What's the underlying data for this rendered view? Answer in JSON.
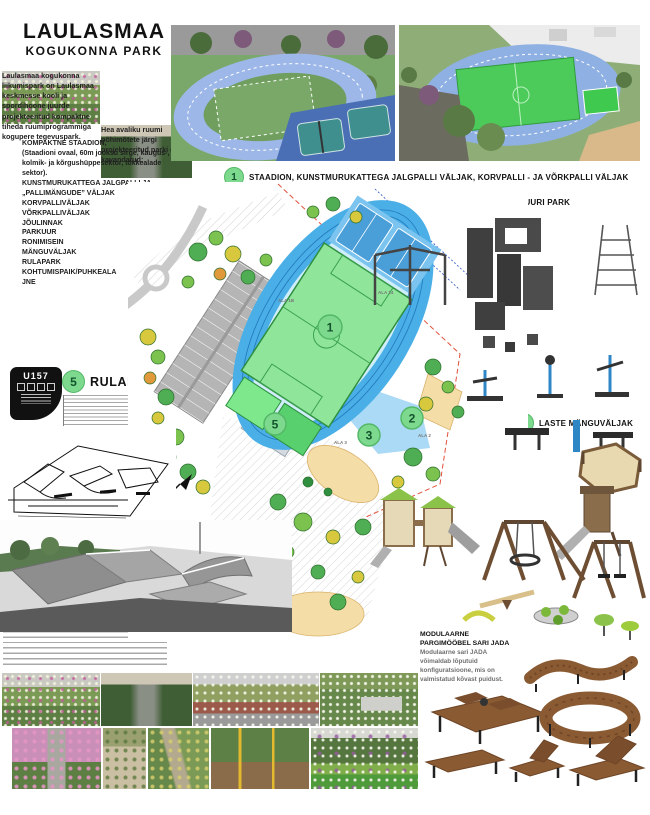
{
  "title": {
    "line1": "LAULASMAA",
    "line2": "KOGUKONNA PARK"
  },
  "intro": {
    "p1": "Laulasmaa kogukonna liikumispark on Laulasmaa keskmesse kooli ja spordihoone juurde projekteeritud kompaktne tiheda ruumiprogrammiga kogupere tegevuspark.",
    "p2": "Hea avaliku ruumi põhimõtete järgi projekteeritud parki on kavandatud:"
  },
  "features": [
    "KOMPAKTNE STAADION,",
    "(Staadioni ovaal, 60m jooksu sirge, kaugus-, kolmik- ja kõrgushüppesektor, tõkkealade sektor).",
    "KUNSTMURUKATTEGA JALGPALLI JA „PALLIMÄNGUDE” VÄLJAK",
    "KORVPALLIVÄLJAK",
    "VÕRKPALLIVÄLJAK",
    "JÕULINNAK",
    "PARKUUR",
    "RONIMISEIN",
    "MÄNGUVÄLJAK",
    "RULAPARK",
    "KOHTUMISPAIK/PUHKEALA",
    "JNE"
  ],
  "labels": {
    "stadium": {
      "num": "1",
      "text": "STAADION, KUNSTMURUKATTEGA JALGPALLI VÄLJAK, KORVPALLI - JA VÕRKPALLI VÄLJAK"
    },
    "gym": {
      "num2": "2",
      "num3": "3",
      "text": "VÕIMLEMISE- /JÕULINNAK JA PARKUURI PARK"
    },
    "playground": {
      "num": "4",
      "text": "LASTE MÄNGUVÄLJAK"
    },
    "skatepark": {
      "num": "5",
      "text": "RULAPARK"
    }
  },
  "markers": [
    "1",
    "2",
    "3",
    "4",
    "5"
  ],
  "plan_area_labels": [
    "ALA 1B",
    "ALA 14",
    "ALA 2",
    "ALA 3"
  ],
  "badge": {
    "code": "U157"
  },
  "furniture": {
    "title1": "MODULAARNE",
    "title2": "PARGIMÖÖBEL SARI JADA",
    "body": "Modulaarne sari JADA võimaldab lõputuid konfiguratsioone, mis on valmistatud kõvast puidust."
  },
  "colors": {
    "marker_green": "#7cd98d",
    "marker_border": "#54b868",
    "track_blue": "#49afe6",
    "pitch_green": "#8fe69b",
    "parking_gray": "#b5b5b5",
    "sand_beige": "#f5dda8",
    "wood_brown": "#8a5a33",
    "equipment_gray": "#3f3f3f"
  }
}
